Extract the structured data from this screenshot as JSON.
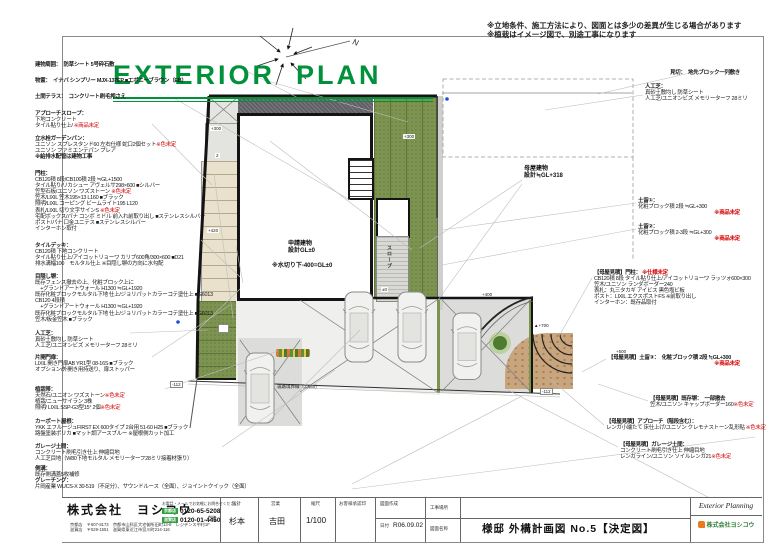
{
  "sheet": {
    "title": "EXTERIOR  PLAN",
    "note1": "※立地条件、施工方法により、図面とは多少の差異が生じる場合があります",
    "note2": "※植栽はイメージ図で、別途工事になります",
    "compass_label": "N"
  },
  "left_specs": [
    {
      "name": "建物周囲",
      "lines": [
        {
          "b": true,
          "seg": [
            {
              "t": "建物周囲：　防草シート 5号砕石敷"
            }
          ]
        }
      ]
    },
    {
      "name": "物置",
      "lines": [
        {
          "b": true,
          "seg": [
            {
              "t": "物置：　イナバ シンプリー MJX-137EP ■エボニーブラウン（EB）"
            }
          ]
        }
      ]
    },
    {
      "name": "土間テラス",
      "lines": [
        {
          "b": true,
          "seg": [
            {
              "t": "土間テラス：　コンクリート刷毛押さえ"
            }
          ]
        }
      ]
    },
    {
      "name": "アプローチスロープ",
      "lines": [
        {
          "b": true,
          "seg": [
            {
              "t": "アプローチスロープ："
            }
          ]
        },
        {
          "seg": [
            {
              "t": "下地コンクリート"
            }
          ]
        },
        {
          "seg": [
            {
              "t": "タイル貼り仕上/ "
            },
            {
              "t": "※商品未定",
              "red": true
            }
          ]
        }
      ]
    },
    {
      "name": "立水栓ガーデンパン",
      "lines": [
        {
          "b": true,
          "seg": [
            {
              "t": "立水栓ガーデンパン："
            }
          ]
        },
        {
          "seg": [
            {
              "t": "ユニソン スプレスタンド60 左右仕様 蛇口2個セット"
            },
            {
              "t": "※色未定",
              "red": true
            }
          ]
        },
        {
          "seg": [
            {
              "t": "ユニソン ファミエンテパン プレア"
            }
          ]
        },
        {
          "b": true,
          "seg": [
            {
              "t": "※給排水配管は建物工事"
            }
          ]
        }
      ]
    },
    {
      "name": "門柱",
      "lines": [
        {
          "b": true,
          "seg": [
            {
              "t": "門柱："
            }
          ]
        },
        {
          "seg": [
            {
              "t": "CB120積 8段/CB100積 2段 ≒GL+1500"
            }
          ]
        },
        {
          "seg": [
            {
              "t": "タイル貼り/リカシュー アヴェルサ298×600 ■シルバー"
            }
          ]
        },
        {
          "seg": [
            {
              "t": "笠型石板/ユニソン ワズストーン "
            },
            {
              "t": "※色未定",
              "red": true
            }
          ]
        },
        {
          "seg": [
            {
              "t": "笠木/LIXIL 笠木195×13 L160 ■ブラック"
            }
          ]
        },
        {
          "seg": [
            {
              "t": "照明/LIXIL コーピング ビームライト195 L120"
            }
          ]
        },
        {
          "seg": [
            {
              "t": "表札/LIXIL 切り文字サインS "
            },
            {
              "t": "※色未定",
              "red": true
            }
          ]
        },
        {
          "seg": [
            {
              "t": "宅配ボックス/パナ コンボ ミドル 前入れ前取り出し ■ステンレスシルバー"
            }
          ]
        },
        {
          "seg": [
            {
              "t": "ポスト/パナ 口金ユニテス ■ステンレスシルバー"
            }
          ]
        },
        {
          "seg": [
            {
              "t": "インターホン取付"
            }
          ]
        }
      ]
    },
    {
      "name": "タイルデッキ",
      "lines": [
        {
          "b": true,
          "seg": [
            {
              "t": "タイルデッキ："
            }
          ]
        },
        {
          "seg": [
            {
              "t": "CB120積 下地コンクリート"
            }
          ]
        },
        {
          "seg": [
            {
              "t": "タイル貼り仕上/アイコットリョーワ カリブ600角/300×600 ■D21"
            }
          ]
        },
        {
          "seg": [
            {
              "t": "排水溝幅100　モルタル仕上 ※目隠し塀の方向に水勾配"
            }
          ]
        }
      ]
    },
    {
      "name": "目隠し塀",
      "lines": [
        {
          "b": true,
          "seg": [
            {
              "t": "目隠し塀："
            }
          ]
        },
        {
          "seg": [
            {
              "t": "既存フェンス撤去の上、化粧ブロック上に"
            }
          ]
        },
        {
          "seg": [
            {
              "t": "　+グランドアートウォール H1300 ≒GL+1920"
            }
          ]
        },
        {
          "seg": [
            {
              "t": "既存化粧ブロックモルタル下地 仕上/ジョリパットカラーコテ塗仕上 ■G6013"
            }
          ]
        },
        {
          "seg": [
            {
              "t": "CB120 4段積"
            }
          ]
        },
        {
          "seg": [
            {
              "t": "　+グランドアートウォール H1300 ≒GL+1920"
            }
          ]
        },
        {
          "seg": [
            {
              "t": "既存化粧ブロックモルタル下地 仕上/ジョリパットカラーコテ塗仕上 ■G6013"
            }
          ]
        },
        {
          "seg": [
            {
              "t": "笠木/板金笠木 ■ブラック"
            }
          ]
        }
      ]
    },
    {
      "name": "人工芝",
      "lines": [
        {
          "b": true,
          "seg": [
            {
              "t": "人工芝："
            }
          ]
        },
        {
          "seg": [
            {
              "t": "真砂土敷均し 防草シート"
            }
          ]
        },
        {
          "seg": [
            {
              "t": "人工芝/ユニオンビズ メモリーターフ 28ミリ"
            }
          ]
        }
      ]
    },
    {
      "name": "片開門扉",
      "lines": [
        {
          "b": true,
          "seg": [
            {
              "t": "片開門扉："
            }
          ]
        },
        {
          "seg": [
            {
              "t": "LIXIL 開き門扉AB YR1型 08-16S ■ブラック"
            }
          ]
        },
        {
          "seg": [
            {
              "t": "オプション/外開き用持送り、扉ストッパー"
            }
          ]
        }
      ]
    },
    {
      "name": "植栽帯",
      "lines": [
        {
          "b": true,
          "seg": [
            {
              "t": "植栽帯："
            }
          ]
        },
        {
          "seg": [
            {
              "t": "天然石/ユニオン ワズストーン"
            },
            {
              "t": "※色未定",
              "red": true
            }
          ]
        },
        {
          "seg": [
            {
              "t": "植栽/ニューサイラン 3株"
            }
          ]
        },
        {
          "seg": [
            {
              "t": "照明/ LIXIL SSP-G3型15° 2個"
            },
            {
              "t": "※色未定",
              "red": true
            }
          ]
        }
      ]
    },
    {
      "name": "カーポート屋根",
      "lines": [
        {
          "b": true,
          "seg": [
            {
              "t": "カーポート屋根："
            }
          ]
        },
        {
          "seg": [
            {
              "t": "YKK エフルージュFIRST EX 600タイプ 2台用 51-60 H25 ■ブラック"
            }
          ]
        },
        {
          "seg": [
            {
              "t": "路盤塗装ポリカ ■マット調アースブルー ※屋根側カット加工"
            }
          ]
        }
      ]
    },
    {
      "name": "ガレージ土間",
      "lines": [
        {
          "b": true,
          "seg": [
            {
              "t": "ガレージ土間："
            }
          ]
        },
        {
          "seg": [
            {
              "t": "コンクリート刷毛引き仕上 伸縮目地"
            }
          ]
        },
        {
          "seg": [
            {
              "t": "人工芝目地（W80下地モルタル メモリーターフ28ミリ接着材張り）"
            }
          ]
        }
      ]
    },
    {
      "name": "側溝",
      "lines": [
        {
          "b": true,
          "seg": [
            {
              "t": "側溝："
            }
          ]
        },
        {
          "seg": [
            {
              "t": "既存側溝蓋5枚補修"
            }
          ]
        },
        {
          "b": true,
          "seg": [
            {
              "t": "グレーチング："
            }
          ]
        },
        {
          "seg": [
            {
              "t": "片岡産業 WUCS-X 30-519（不足分）、サウンドルース（全面）、ジョイントクイック（全面）"
            }
          ]
        }
      ]
    }
  ],
  "right_specs": [
    {
      "name": "見切",
      "lines": [
        {
          "b": true,
          "seg": [
            {
              "t": "見切：　地先ブロック一列敷き"
            }
          ]
        }
      ]
    },
    {
      "name": "人工芝右",
      "lines": [
        {
          "b": true,
          "seg": [
            {
              "t": "人工芝："
            }
          ]
        },
        {
          "seg": [
            {
              "t": "真砂土敷均し 防草シート"
            }
          ]
        },
        {
          "seg": [
            {
              "t": "人工芝/ユニオンビズ メモリーターフ 28ミリ"
            }
          ]
        }
      ]
    },
    {
      "name": "土留1",
      "lines": [
        {
          "b": true,
          "seg": [
            {
              "t": "土留①："
            }
          ]
        },
        {
          "seg": [
            {
              "t": "化粧ブロック積 2段 ≒GL+300"
            }
          ]
        },
        {
          "ra": true,
          "b": true,
          "seg": [
            {
              "t": "※商品未定",
              "red": true
            }
          ]
        }
      ]
    },
    {
      "name": "土留2",
      "lines": [
        {
          "b": true,
          "seg": [
            {
              "t": "土留②："
            }
          ]
        },
        {
          "seg": [
            {
              "t": "化粧ブロック積 2-3段 ≒GL+300"
            }
          ]
        },
        {
          "ra": true,
          "b": true,
          "seg": [
            {
              "t": "※商品未定",
              "red": true
            }
          ]
        }
      ]
    },
    {
      "name": "母屋門柱",
      "lines": [
        {
          "b": true,
          "seg": [
            {
              "t": "【母屋見積】門柱： "
            },
            {
              "t": "※仕様未定",
              "red": true
            }
          ]
        },
        {
          "seg": [
            {
              "t": "CB120積 8段 タイル貼り仕上/アイコットリョーワ ラッツォ600×300"
            }
          ]
        },
        {
          "seg": [
            {
              "t": "笠木/ユニソン ランダボーダー240"
            }
          ]
        },
        {
          "seg": [
            {
              "t": "表札：丸三タカギ アイビス 黒色塩ビ板"
            }
          ]
        },
        {
          "seg": [
            {
              "t": "ポスト：LIXIL エクスポストFS ※前取り出し"
            }
          ]
        },
        {
          "seg": [
            {
              "t": "インターホン：既存品取付"
            }
          ]
        }
      ]
    },
    {
      "name": "母屋土留3",
      "lines": [
        {
          "b": true,
          "seg": [
            {
              "t": "【母屋見積】土留③：　化粧ブロック積 2段 ≒GL+300"
            }
          ]
        },
        {
          "ra": true,
          "b": true,
          "seg": [
            {
              "t": "※商品未定",
              "red": true
            }
          ]
        }
      ]
    },
    {
      "name": "母屋既存塀",
      "lines": [
        {
          "b": true,
          "seg": [
            {
              "t": "【母屋見積】既存塀：　一部撤去"
            }
          ]
        },
        {
          "seg": [
            {
              "t": "笠木/ユニソン キャップボーダー160"
            },
            {
              "t": "※色未定",
              "red": true
            }
          ]
        }
      ]
    },
    {
      "name": "母屋アプローチ",
      "lines": [
        {
          "b": true,
          "seg": [
            {
              "t": "【母屋見積】アプローチ（階段含む）："
            }
          ]
        },
        {
          "seg": [
            {
              "t": "レンガ小端たて 床仕上げ/ユニソン クレモナストーン乱形貼 "
            },
            {
              "t": "※色未定",
              "red": true
            }
          ]
        }
      ]
    },
    {
      "name": "母屋ガレージ",
      "lines": [
        {
          "b": true,
          "seg": [
            {
              "t": "【母屋見積】ガレージ土間："
            }
          ]
        },
        {
          "seg": [
            {
              "t": "コンクリート刷毛引き仕上 伸縮目地"
            }
          ]
        },
        {
          "seg": [
            {
              "t": "レンガライン/ユニソン ソイルレンガ21"
            },
            {
              "t": "※色未定",
              "red": true
            }
          ]
        }
      ]
    }
  ],
  "plan": {
    "omoya1": "母屋建物",
    "omoya2": "設計≒GL+318",
    "main1": "申請建物",
    "main2": "設計GL±0",
    "mizukiri": "※水切り下-400=GL±0",
    "road": "道路境界線（3,680）",
    "ramp": "スロープ",
    "dims": {
      "landing": "+300",
      "step2": "2",
      "mid": "+420",
      "zero": "±0",
      "green300": "+300",
      "d400": "+400",
      "d700": "▲+700",
      "d500": "+500",
      "m112a": "-112",
      "m112b": "-112"
    }
  },
  "titleblock": {
    "company": {
      "name": "株式会社　ヨシコウ",
      "addr1": "京都店　〒607-8173　京都市山科区大宅御所田町13-8　レジデンス中村1F",
      "addr2": "滋賀店　〒529-1551　滋賀県東近江市宮川町214-116",
      "note": "お電話・メールでお気軽にお問合せください",
      "tel1_label": "京都店",
      "tel1": "0120-65-5208",
      "tel2_label": "滋賀店",
      "tel2": "0120-01-4450",
      "mail_icon": "✉"
    },
    "sekkei_label": "設計",
    "sekkei": "杉本",
    "eigyo_label": "営業",
    "eigyo": "吉田",
    "scale_label": "縮尺",
    "scale": "1/100",
    "approval_label": "お客様承認印",
    "sakusei_label": "図面作成",
    "date_label": "日付",
    "date": "R06.09.02",
    "koji_label": "工事場所",
    "zumen_label": "図面名称",
    "zumen_title": "様邸 外構計画図 No.5【決定図】",
    "logo_top": "Exterior Planning",
    "logo_name": "株式会社ヨシコウ"
  }
}
